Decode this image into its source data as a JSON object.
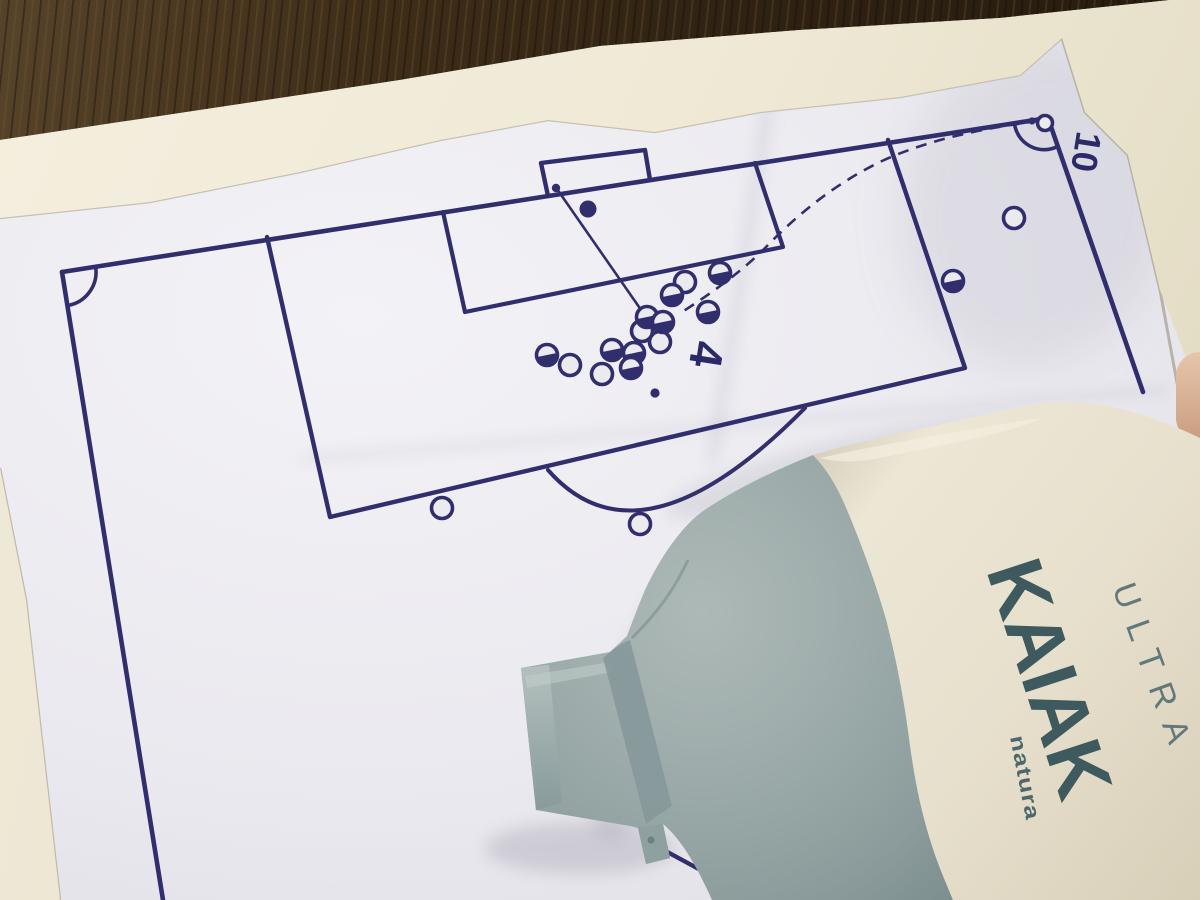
{
  "scene": {
    "kind": "photo of a printed corner-kick tactics sheet on a wooden table, partly covered by a deodorant spray bottle",
    "colors": {
      "ink": "#312e6d",
      "paper": "#eae9ef",
      "under_sheet": "#efe9d6",
      "wood": "#33261505",
      "bottle_body": "#e9e3d2",
      "bottle_gray": "#9aa9a8",
      "bottle_text": "#3e5a5e",
      "finger": "#d8b093"
    }
  },
  "diagram": {
    "ink_color": "#312e6d",
    "labels": {
      "corner_taker": "10",
      "target_player": "4"
    },
    "attackers_half_filled": [
      [
        547,
        355
      ],
      [
        612,
        350
      ],
      [
        634,
        353
      ],
      [
        631,
        368
      ],
      [
        647,
        317
      ],
      [
        663,
        322
      ],
      [
        672,
        295
      ],
      [
        708,
        312
      ],
      [
        720,
        273
      ],
      [
        953,
        281
      ]
    ],
    "defenders_hollow": [
      [
        570,
        365
      ],
      [
        602,
        374
      ],
      [
        642,
        331
      ],
      [
        660,
        342
      ],
      [
        685,
        282
      ],
      [
        1014,
        218
      ],
      [
        442,
        508
      ],
      [
        640,
        524
      ]
    ],
    "corner_player_hollow": [
      1045,
      123
    ],
    "goalkeeper_filled": [
      588,
      209
    ],
    "dots": {
      "ball_in_goal": [
        556,
        188
      ],
      "ball_at_corner": [
        1032,
        121
      ],
      "penalty_spot": [
        655,
        393
      ]
    },
    "trajectories": {
      "cross_dashed": "M1038,121 C985,128 930,139 882,161 C838,182 800,212 768,245 C745,269 712,293 682,312",
      "shot_solid": "M557,189 L646,317"
    }
  },
  "bottle": {
    "brand": "natura",
    "product": "KAIAK",
    "variant": "ULTRA"
  }
}
